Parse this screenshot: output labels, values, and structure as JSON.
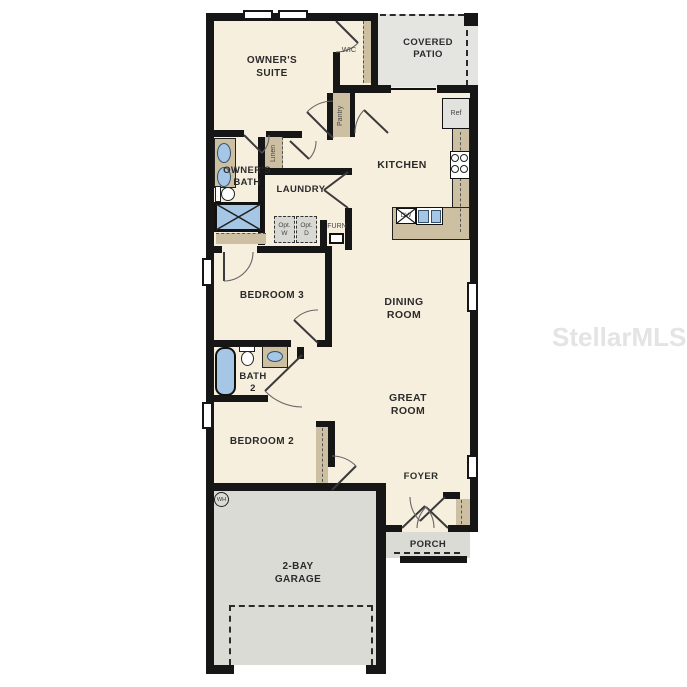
{
  "watermark": {
    "text": "StellarMLS"
  },
  "colors": {
    "wall": "#161616",
    "floor": "#f7efde",
    "tan": "#cdbfa2",
    "garage_gray": "#dbdbd6",
    "patio_gray": "#e4e4e0",
    "fixture_blue": "#a5c6e4"
  },
  "rooms": {
    "owners_suite": {
      "label": "OWNER'S SUITE"
    },
    "wic": {
      "label": "WIC"
    },
    "covered_patio": {
      "label": "COVERED PATIO"
    },
    "kitchen": {
      "label": "KITCHEN"
    },
    "owners_bath": {
      "label": "OWNER'S BATH"
    },
    "laundry": {
      "label": "LAUNDRY"
    },
    "bedroom3": {
      "label": "BEDROOM 3"
    },
    "dining": {
      "label": "DINING ROOM"
    },
    "bath2": {
      "label": "BATH 2"
    },
    "great": {
      "label": "GREAT ROOM"
    },
    "bedroom2": {
      "label": "BEDROOM 2"
    },
    "foyer": {
      "label": "FOYER"
    },
    "porch": {
      "label": "PORCH"
    },
    "garage": {
      "label": "2-BAY GARAGE"
    }
  },
  "fixtures": {
    "pantry": "Pantry",
    "linen": "Linen",
    "ref": "Ref",
    "dw": "DW",
    "opt_w": "Opt. W",
    "opt_d": "Opt. D",
    "furn": "FURN",
    "wh": "WH"
  }
}
